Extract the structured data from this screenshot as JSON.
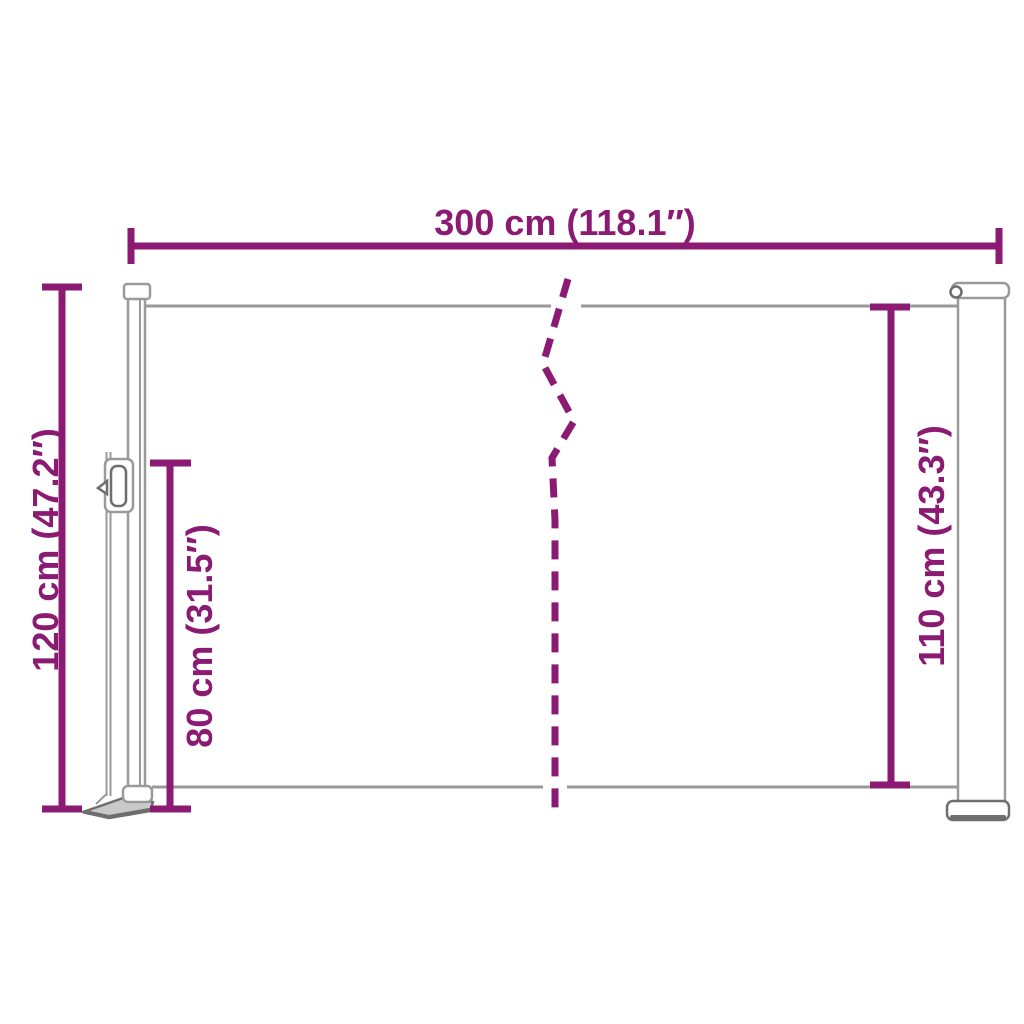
{
  "colors": {
    "background": "#ffffff",
    "accent": "#8B1A73",
    "line_gray": "#9a9a9a",
    "dark_gray": "#6e6e6e",
    "plate_fill": "#c9c9c9"
  },
  "labels": {
    "width_top": "300 cm (118.1″)",
    "height_left_total": "120 cm (47.2″)",
    "height_left_inner": "80 cm (31.5″)",
    "height_right": "110 cm (43.3″)"
  }
}
